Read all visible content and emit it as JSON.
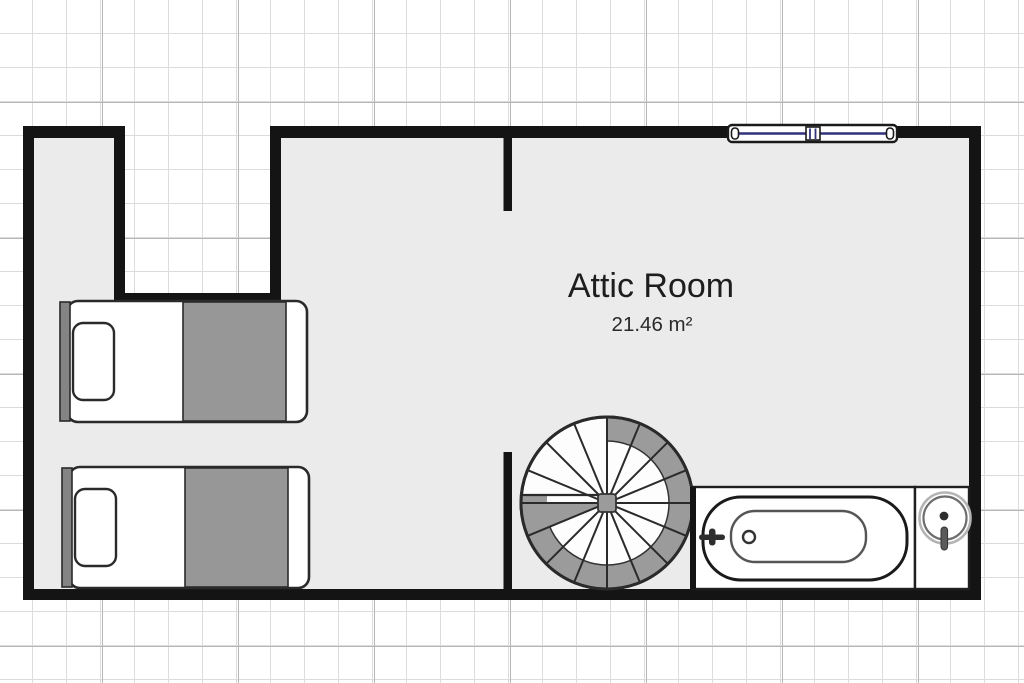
{
  "room": {
    "label": "Attic Room",
    "area": "21.46 m²"
  },
  "fixtures": {
    "beds": [
      {
        "name": "single-bed-top"
      },
      {
        "name": "single-bed-bottom"
      }
    ],
    "staircase": {
      "name": "spiral-staircase"
    },
    "bathtub": {
      "name": "bathtub"
    },
    "sink": {
      "name": "round-sink"
    },
    "window": {
      "name": "double-casement-window"
    }
  },
  "colors": {
    "wall": "#141414",
    "floor": "#ebebeb",
    "furniture_gray": "#979797",
    "headboard_gray": "#848484",
    "outline": "#2a2a2a",
    "window_accent": "#32327e",
    "grid_minor": "#dcdcdc",
    "grid_major": "#b6b6b6",
    "background": "#ffffff",
    "text": "#1e1e1e"
  }
}
